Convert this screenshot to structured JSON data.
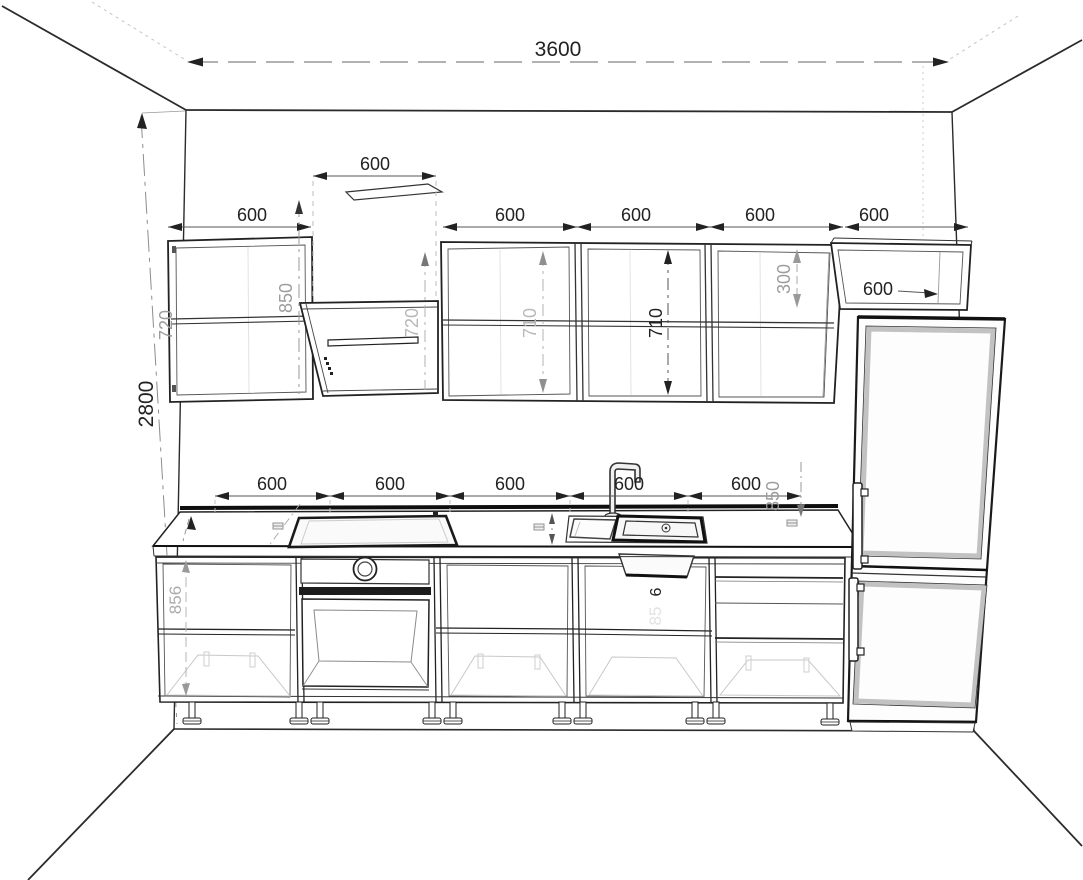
{
  "dimensions": {
    "room": {
      "width": "3600",
      "height": "2800"
    },
    "upper_row": {
      "left_cabinet_width": "600",
      "left_cabinet_height": "720",
      "hood_width": "600",
      "hood_height": "720",
      "hood_clearance": "850",
      "cabinet1_width": "600",
      "cabinet2_width": "600",
      "cabinet3_width": "600",
      "cabinet1_height": "710",
      "cabinet2_height": "710",
      "corner_cabinet_width": "600",
      "corner_cabinet_height": "300",
      "corner_cabinet_depth": "600"
    },
    "base_row": {
      "cabinet1_width": "600",
      "cabinet2_width": "600",
      "cabinet3_width": "600",
      "cabinet4_width": "600",
      "cabinet5_width": "600",
      "worktop_height": "850",
      "carcass_height": "856",
      "carcass_height_partial": "6",
      "carcass_height_ghost": "85"
    }
  }
}
